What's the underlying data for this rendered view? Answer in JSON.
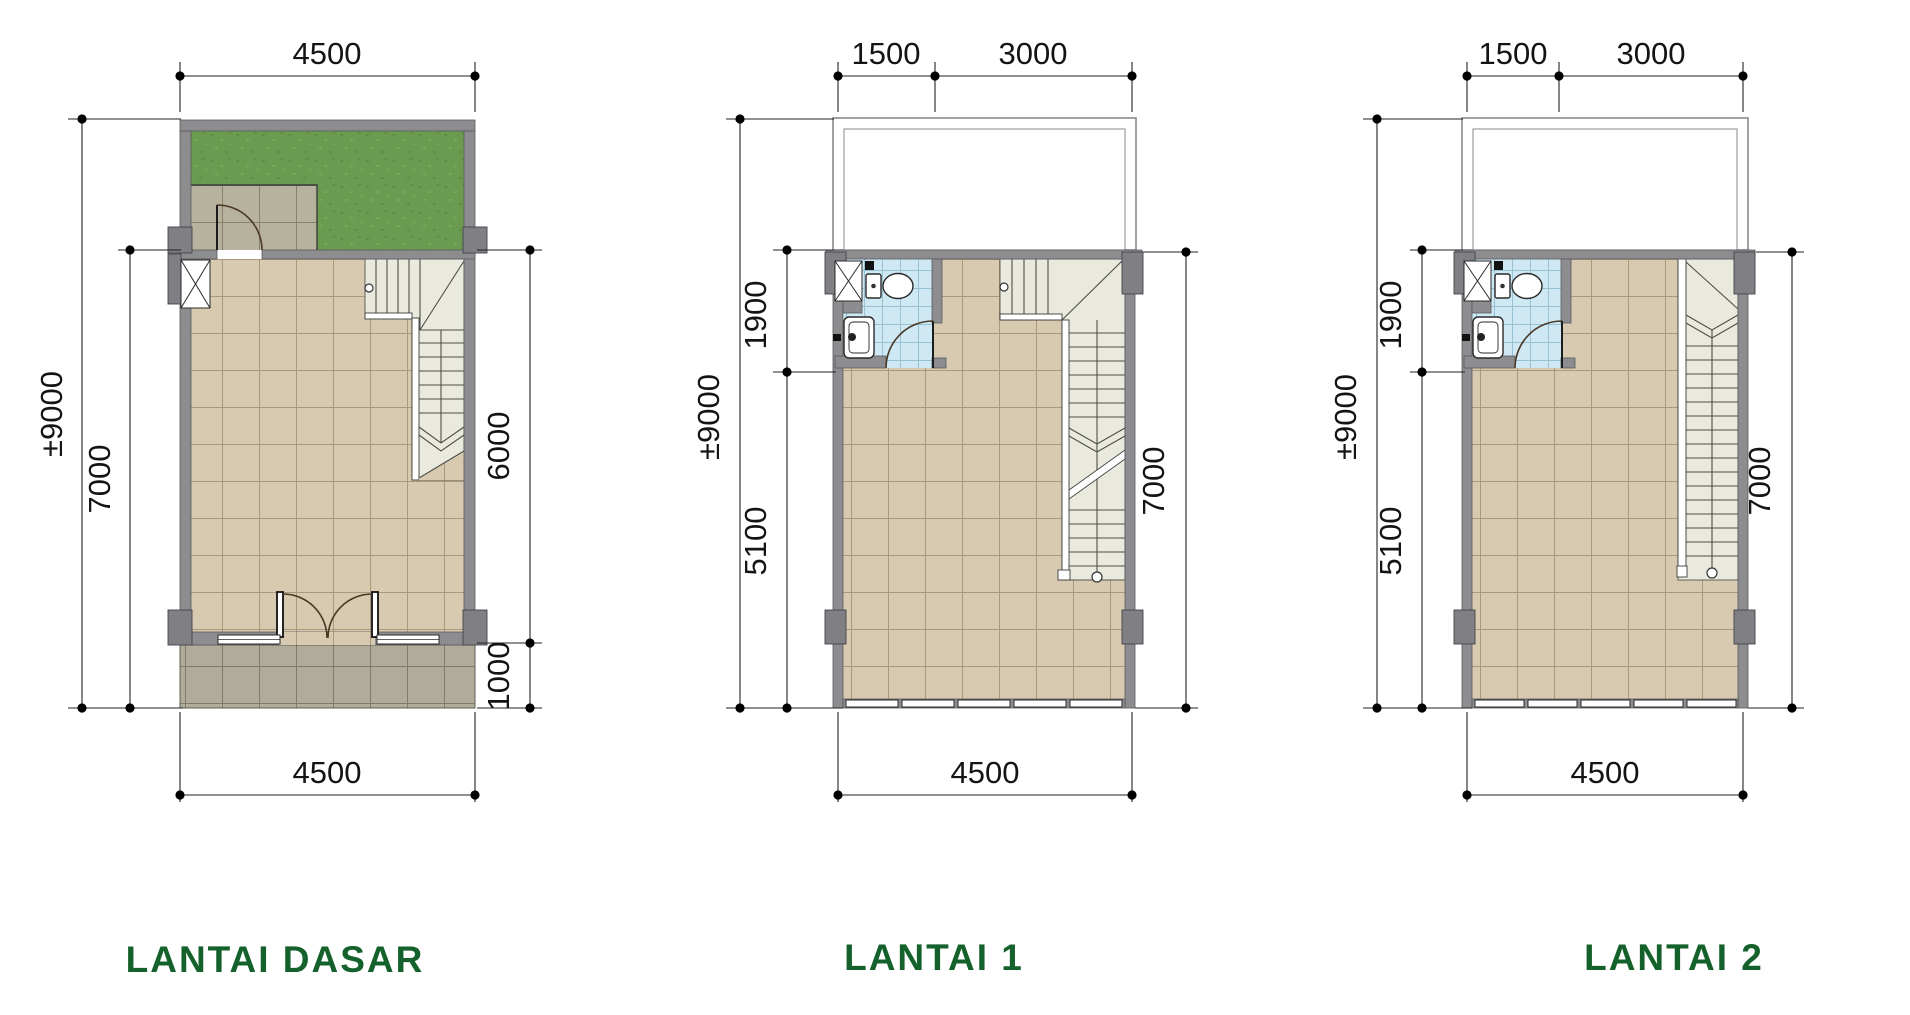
{
  "sheet": {
    "type": "architectural floor plan sheet",
    "plans": [
      {
        "name": "lantai-dasar",
        "label": "LANTAI DASAR",
        "dims": {
          "top": "4500",
          "left_outer": "±9000",
          "left_inner": "7000",
          "right_upper": "6000",
          "right_lower": "1000",
          "bottom": "4500"
        }
      },
      {
        "name": "lantai-1",
        "label": "LANTAI 1",
        "dims": {
          "top_left": "1500",
          "top_right": "3000",
          "left_outer": "±9000",
          "left_upper": "1900",
          "left_lower": "5100",
          "right": "7000",
          "bottom": "4500"
        }
      },
      {
        "name": "lantai-2",
        "label": "LANTAI 2",
        "dims": {
          "top_left": "1500",
          "top_right": "3000",
          "left_outer": "±9000",
          "left_upper": "1900",
          "left_lower": "5100",
          "right": "7000",
          "bottom": "4500"
        }
      }
    ],
    "colors": {
      "label_green": "#15612c",
      "wall_grey": "#8d8d90",
      "column_grey": "#7f7f84",
      "floor_beige": "#d7cab0",
      "porch_grey": "#b7b29e",
      "terrace_grey": "#b1ac99",
      "garden_green": "#6b9b51",
      "bathroom_blue": "#cfe9f4",
      "stair_cream": "#e9e9de",
      "dimension_black": "#141414"
    }
  }
}
